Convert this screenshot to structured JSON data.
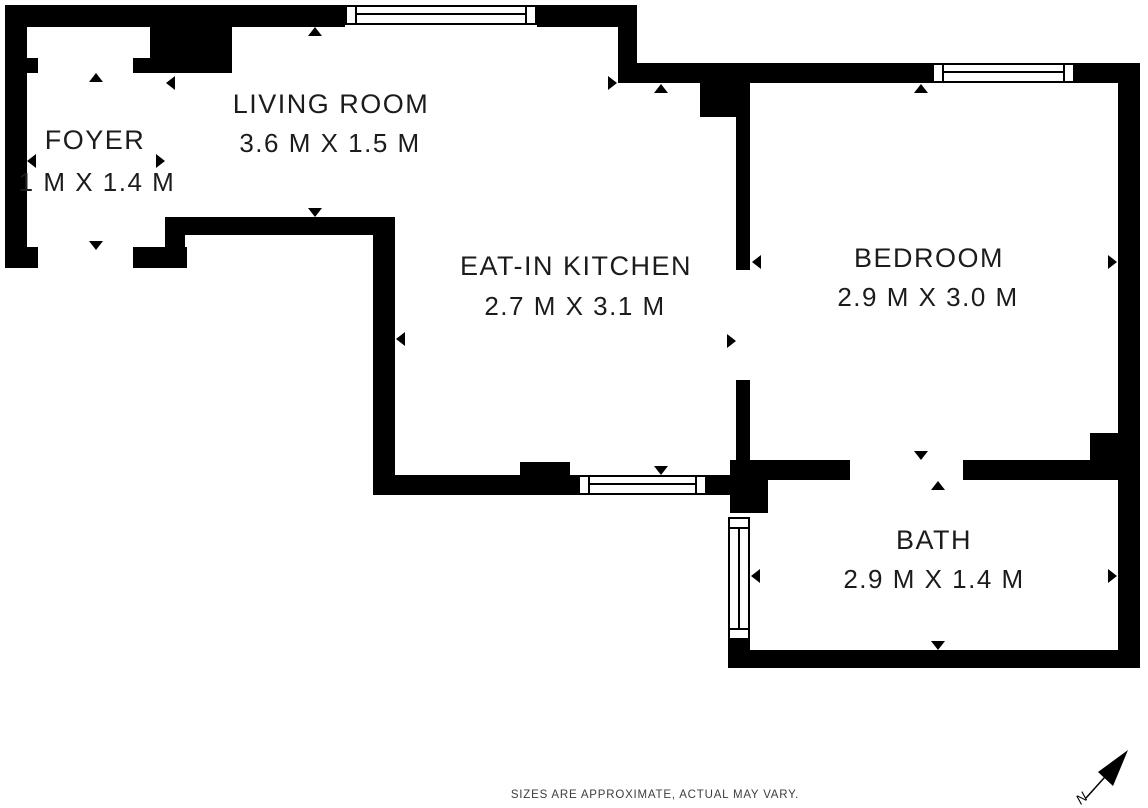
{
  "rooms": {
    "foyer": {
      "name": "FOYER",
      "dims": "1 M X 1.4 M"
    },
    "living_room": {
      "name": "LIVING ROOM",
      "dims": "3.6 M X 1.5 M"
    },
    "kitchen": {
      "name": "EAT-IN KITCHEN",
      "dims": "2.7 M X 3.1 M"
    },
    "bedroom": {
      "name": "BEDROOM",
      "dims": "2.9 M X 3.0 M"
    },
    "bath": {
      "name": "BATH",
      "dims": "2.9 M X 1.4 M"
    }
  },
  "footer": {
    "disclaimer": "SIZES ARE APPROXIMATE, ACTUAL MAY VARY."
  },
  "compass": {
    "label": "N"
  },
  "colors": {
    "wall": "#000000",
    "bg": "#ffffff",
    "label": "#1c1c1c",
    "footer": "#3d3d3d"
  }
}
